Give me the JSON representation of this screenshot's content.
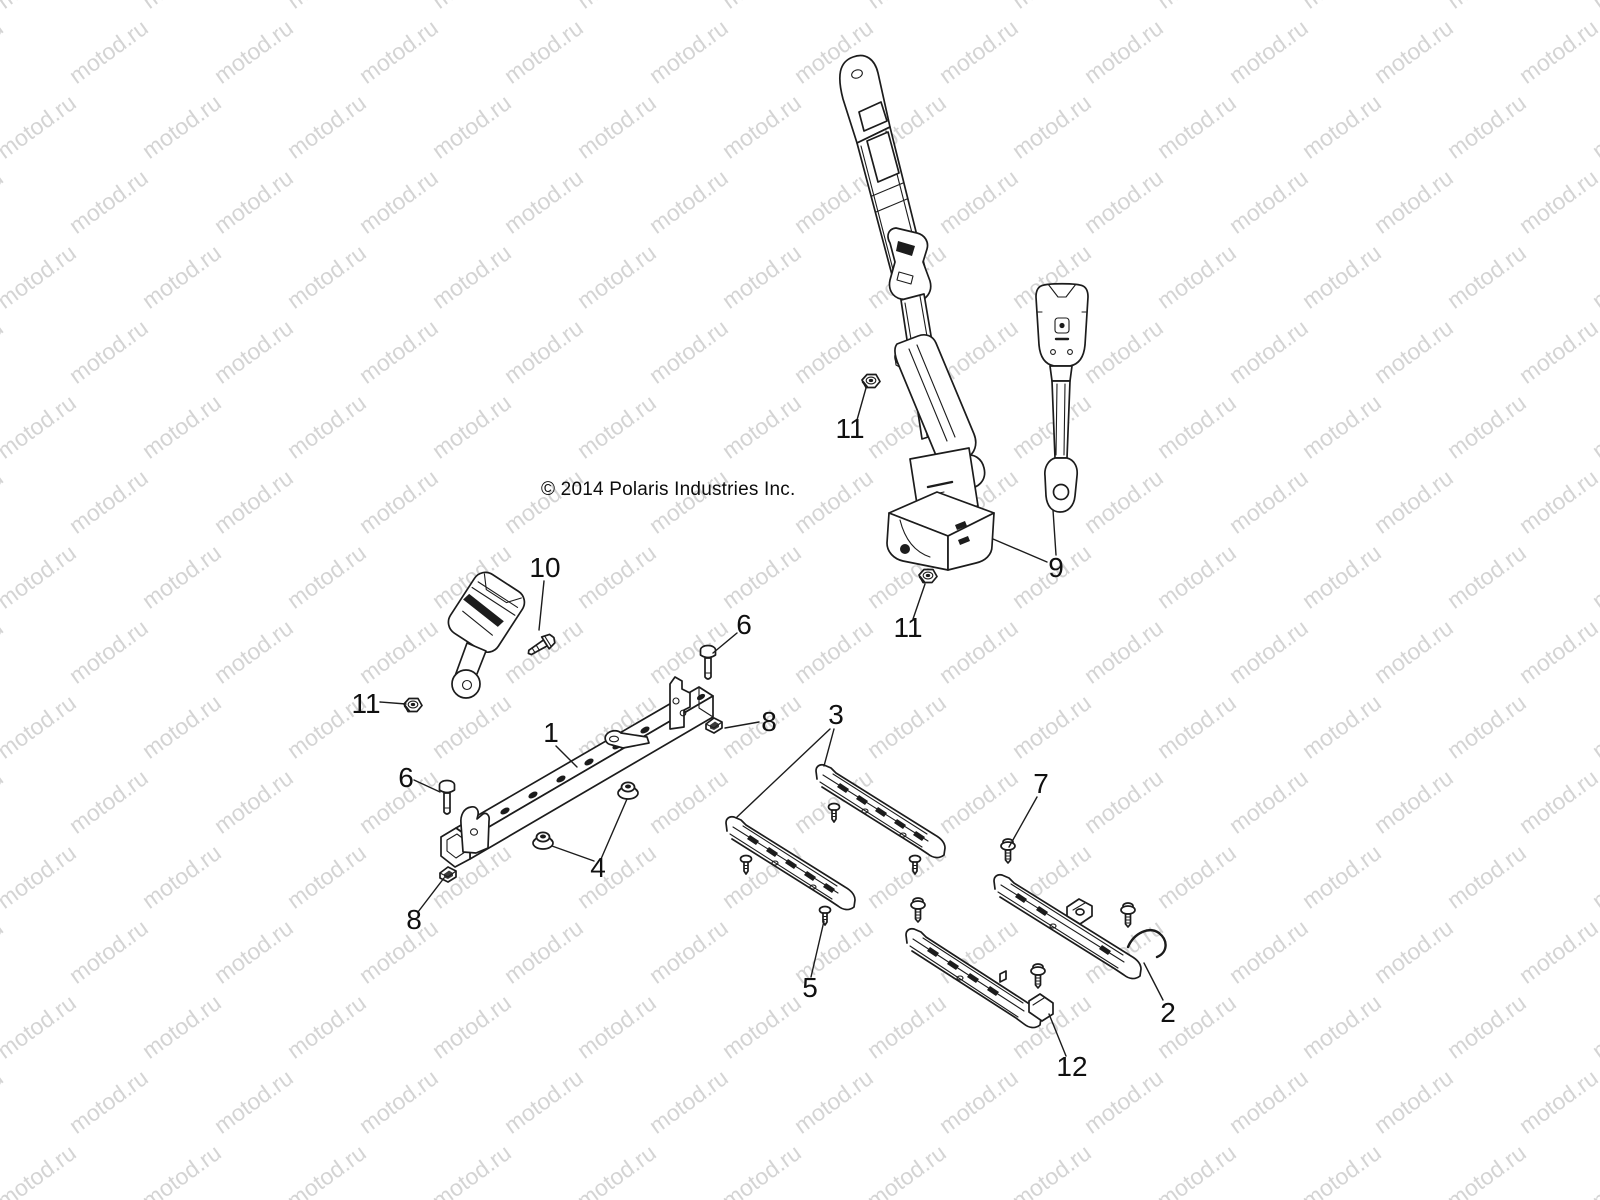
{
  "watermark": {
    "text": "motod.ru",
    "color": "#d4d4d4",
    "font_size_px": 23,
    "rotation_deg": -36,
    "col_spacing_px": 145,
    "row_spacing_px": 75,
    "row_offset_px": 72,
    "rows": 17,
    "cols": 13
  },
  "copyright": {
    "text": "© 2014 Polaris Industries Inc."
  },
  "diagram": {
    "line_color": "#1c1c1c",
    "callout_font_size_px": 28,
    "callouts": [
      {
        "label": "1",
        "x": 551,
        "y": 742,
        "leaders": [
          [
            556,
            746,
            577,
            767
          ]
        ]
      },
      {
        "label": "2",
        "x": 1168,
        "y": 1022,
        "leaders": [
          [
            1163,
            1000,
            1144,
            963
          ]
        ]
      },
      {
        "label": "3",
        "x": 836,
        "y": 724,
        "leaders": [
          [
            834,
            729,
            824,
            766
          ],
          [
            830,
            729,
            737,
            817
          ]
        ]
      },
      {
        "label": "4",
        "x": 598,
        "y": 877,
        "leaders": [
          [
            594,
            861,
            552,
            846
          ],
          [
            601,
            859,
            627,
            799
          ]
        ]
      },
      {
        "label": "5",
        "x": 810,
        "y": 997,
        "leaders": [
          [
            811,
            977,
            824,
            921
          ]
        ]
      },
      {
        "label": "6",
        "x": 744,
        "y": 634,
        "leaders": [
          [
            737,
            633,
            713,
            653
          ]
        ]
      },
      {
        "label": "6",
        "x": 406,
        "y": 787,
        "leaders": [
          [
            414,
            780,
            440,
            792
          ]
        ]
      },
      {
        "label": "7",
        "x": 1041,
        "y": 793,
        "leaders": [
          [
            1037,
            797,
            1009,
            847
          ]
        ]
      },
      {
        "label": "8",
        "x": 769,
        "y": 731,
        "leaders": [
          [
            759,
            722,
            725,
            728
          ]
        ]
      },
      {
        "label": "8",
        "x": 414,
        "y": 929,
        "leaders": [
          [
            418,
            912,
            444,
            878
          ]
        ]
      },
      {
        "label": "9",
        "x": 1056,
        "y": 577,
        "leaders": [
          [
            1047,
            562,
            993,
            539
          ],
          [
            1056,
            555,
            1053,
            510
          ]
        ]
      },
      {
        "label": "10",
        "x": 545,
        "y": 577,
        "leaders": [
          [
            544,
            581,
            539,
            630
          ]
        ]
      },
      {
        "label": "11",
        "x": 850,
        "y": 438,
        "leaders": [
          [
            857,
            420,
            866,
            388
          ]
        ]
      },
      {
        "label": "11",
        "x": 908,
        "y": 637,
        "leaders": [
          [
            913,
            619,
            925,
            584
          ]
        ]
      },
      {
        "label": "11",
        "x": 366,
        "y": 713,
        "leaders": [
          [
            380,
            702,
            406,
            704
          ]
        ]
      },
      {
        "label": "12",
        "x": 1072,
        "y": 1076,
        "leaders": [
          [
            1066,
            1056,
            1049,
            1014
          ]
        ]
      }
    ]
  }
}
